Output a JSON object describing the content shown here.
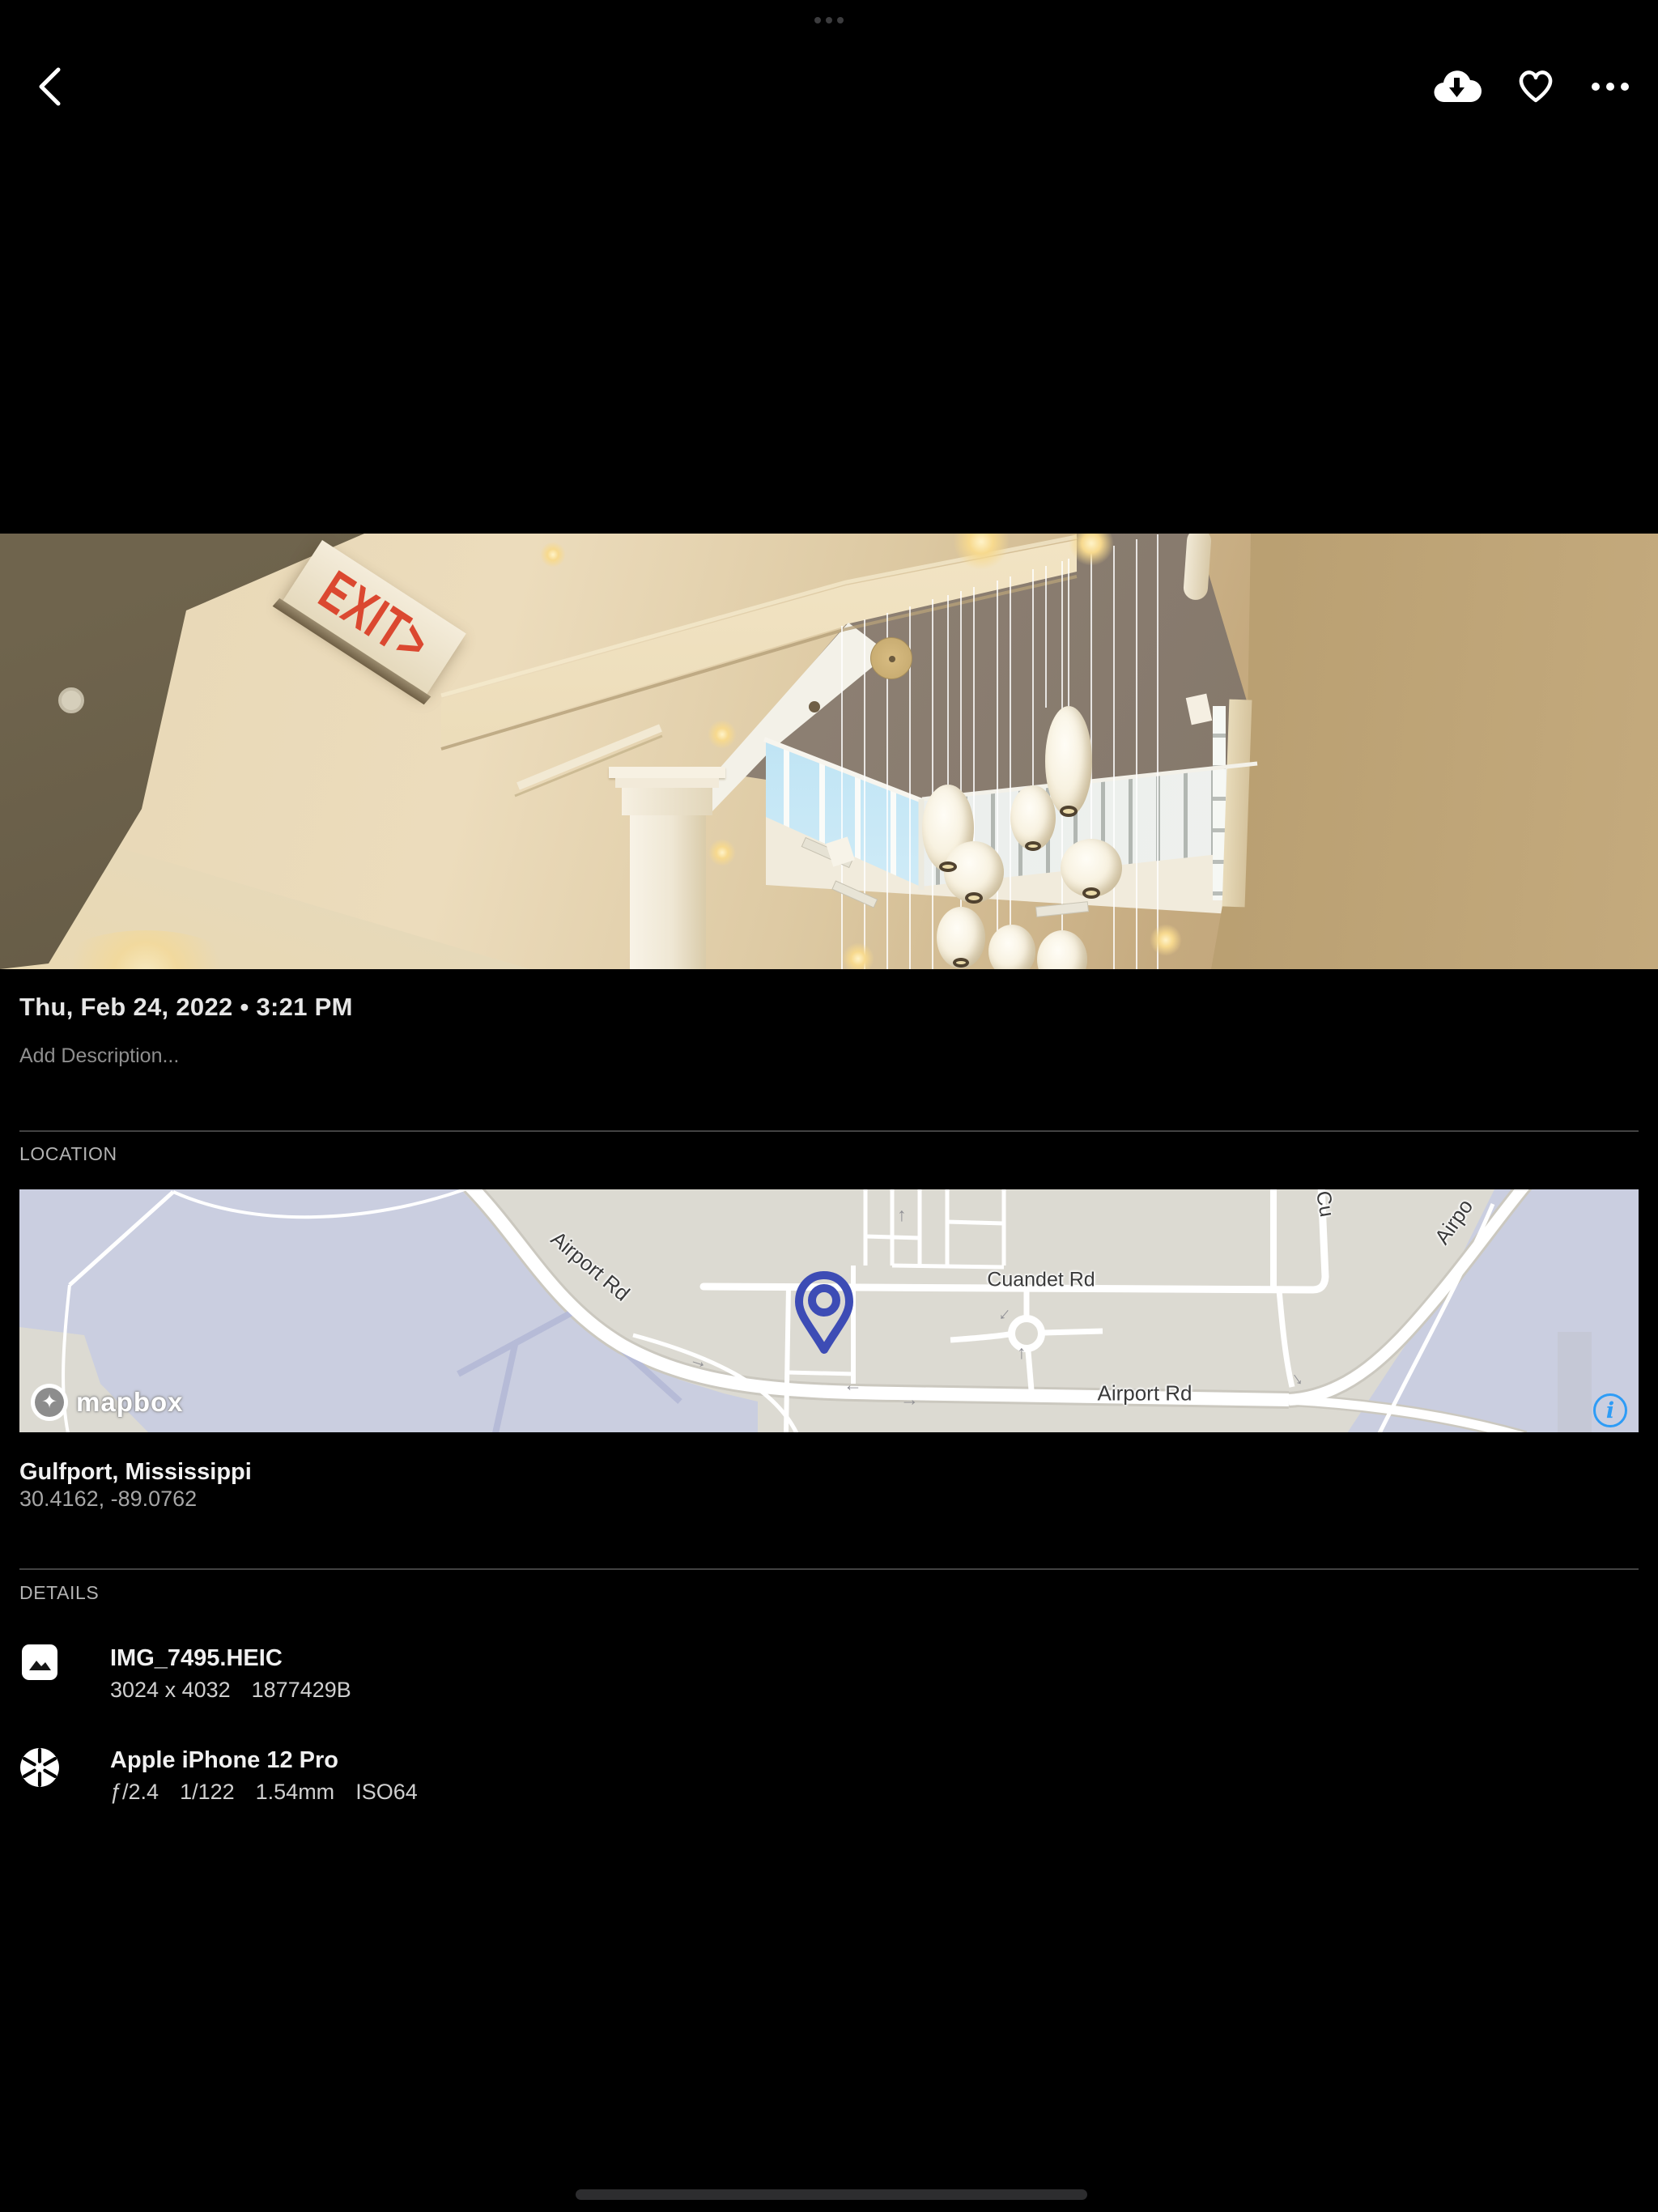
{
  "colors": {
    "accent_blue": "#2E9CF6",
    "map_pin": "#3D4CB5",
    "exit_red": "#DB4830"
  },
  "toolbar": {
    "icons": [
      "back",
      "download",
      "favorite",
      "more"
    ]
  },
  "photo": {
    "exit_sign": "EXIT>"
  },
  "meta": {
    "date_line": "Thu, Feb 24, 2022 • 3:21 PM",
    "description_placeholder": "Add Description..."
  },
  "location": {
    "section_label": "LOCATION",
    "place": "Gulfport, Mississippi",
    "coordinates": "30.4162, -89.0762",
    "map": {
      "labels": {
        "airport_rd_nw": "Airport Rd",
        "cuandet_rd": "Cuandet Rd",
        "airport_rd_s": "Airport Rd",
        "airport_rd_ne": "Airpo",
        "cuandet_partial": "Cu"
      },
      "attribution": "mapbox",
      "info_glyph": "i"
    }
  },
  "details": {
    "section_label": "DETAILS",
    "file": {
      "name": "IMG_7495.HEIC",
      "dimensions": "3024 x 4032",
      "size": "1877429B"
    },
    "camera": {
      "name": "Apple iPhone 12 Pro",
      "aperture": "ƒ/2.4",
      "shutter": "1/122",
      "focal_length": "1.54mm",
      "iso": "ISO64"
    }
  }
}
